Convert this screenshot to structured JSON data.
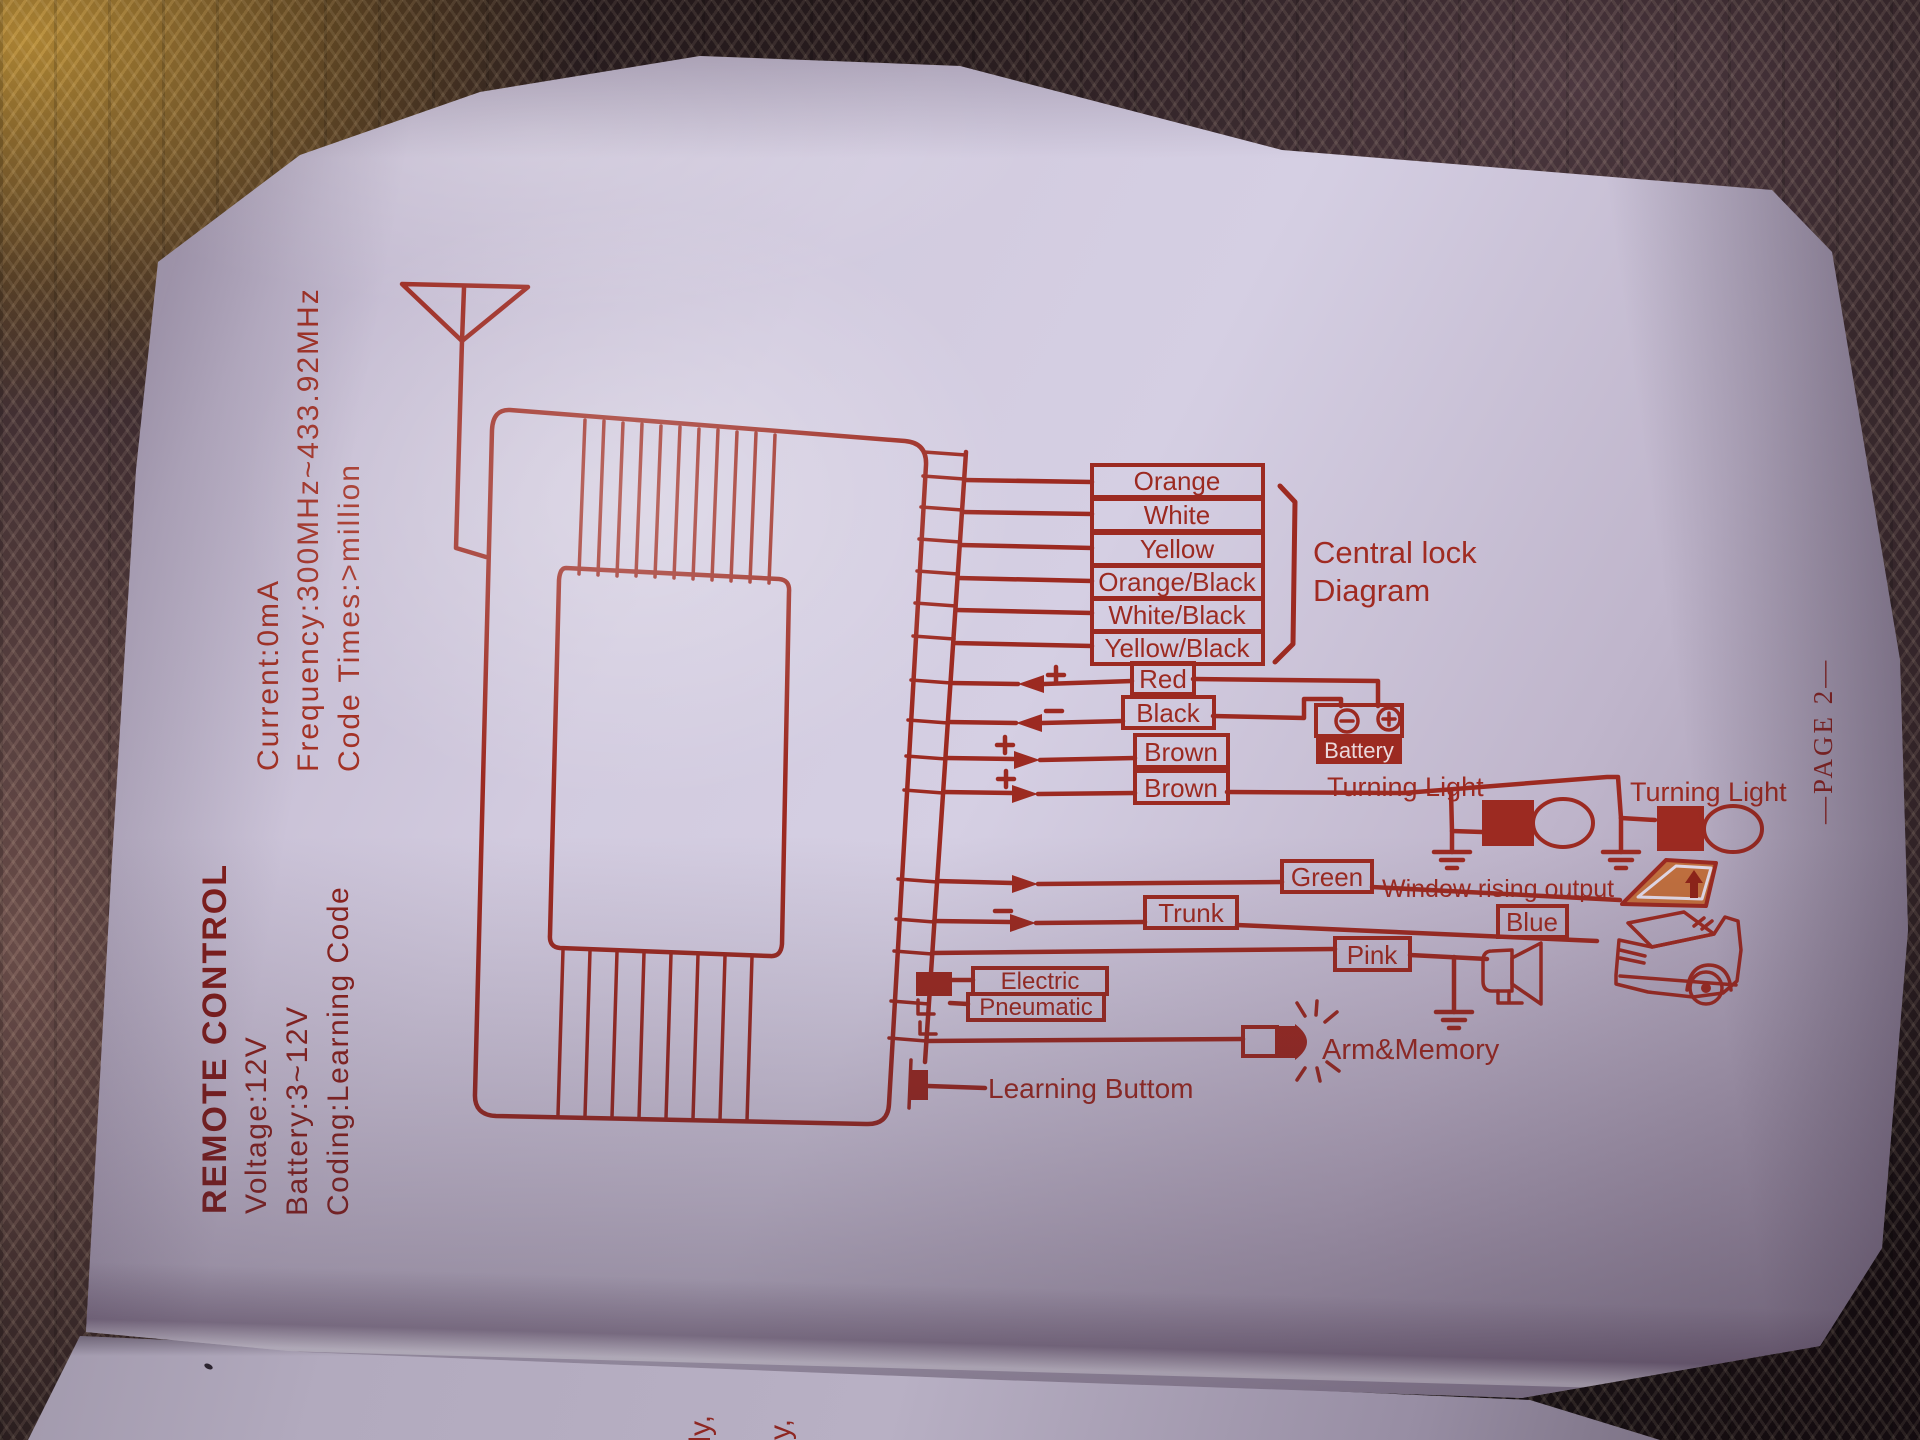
{
  "colors": {
    "ink": "#9c2a21",
    "page": "#d2cbdf",
    "window_fill": "#c2703e",
    "battery_fill": "#9c2a21"
  },
  "specs": {
    "title": "REMOTE CONTROL",
    "voltage": "Voltage:12V",
    "battery": "Battery:3~12V",
    "coding": "Coding:Learning Code",
    "current": "Current:0mA",
    "frequency": "Frequency:300MHz~433.92MHz",
    "code_times": "Code Times:>million"
  },
  "central_lock": {
    "wires": [
      "Orange",
      "White",
      "Yellow",
      "Orange/Black",
      "White/Black",
      "Yellow/Black"
    ],
    "caption_line1": "Central lock",
    "caption_line2": "Diagram"
  },
  "power": {
    "red": "Red",
    "black": "Black",
    "battery": "Battery",
    "plus": "+",
    "minus": "-"
  },
  "turning": {
    "brown_a": "Brown",
    "brown_b": "Brown",
    "label_a": "Turning Light",
    "label_b": "Turning Light"
  },
  "outputs": {
    "green": "Green",
    "window_caption": "Window rising output",
    "trunk": "Trunk",
    "blue": "Blue",
    "pink": "Pink",
    "electric": "Electric",
    "pneumatic": "Pneumatic",
    "arm_memory": "Arm&Memory",
    "learning": "Learning Buttom"
  },
  "page_label": "—PAGE 2—",
  "under_page_fragments": [
    "y,",
    "ally,",
    "ally,"
  ]
}
